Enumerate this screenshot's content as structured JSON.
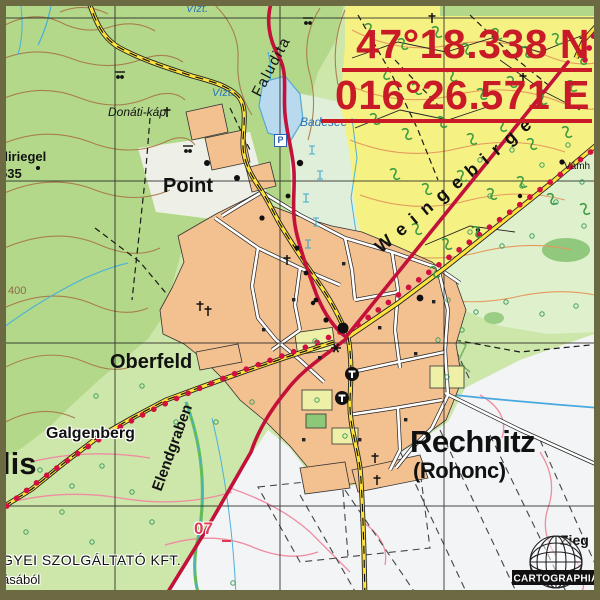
{
  "coordinates": {
    "latitude": "47°18.338 N",
    "longitude": "016°26.571 E",
    "color": "#c91a28"
  },
  "labels": {
    "vizt_top": "Vízt.",
    "faludita": "Faludita",
    "vizt_mid": "Vízt.",
    "badesee": "Badesee",
    "donati_kap": "Donáti-káp.",
    "diriegel": "diriegel",
    "spot_height_535": "535",
    "point": "Point",
    "weingebirge": "Weingebirge",
    "vamh": "Vámh",
    "oberfeld": "Oberfeld",
    "galgenberg": "Galgenberg",
    "lis_partial": "lis",
    "elendgraben": "Elendgraben",
    "rechnitz": "Rechnitz",
    "rohonc": "(Rohonc)",
    "road_07": "07",
    "contour_400": "400",
    "credit_line1": "GYEI SZOLGÁLTATÓ KFT.",
    "credit_line2": "ásából",
    "zieg_partial": "Zieg",
    "parking": "P"
  },
  "logo": {
    "name": "CARTOGRAPHIA"
  },
  "colors": {
    "frame": "#6b6a42",
    "main_road": "#c2123a",
    "secondary_road": "#ffe33c",
    "border_dots": "#d1103f",
    "forest": "#b3d88a",
    "vineyard": "#f5f183",
    "town": "#f3c090",
    "water": "#b9d9ef",
    "accent_red": "#c91a28"
  }
}
